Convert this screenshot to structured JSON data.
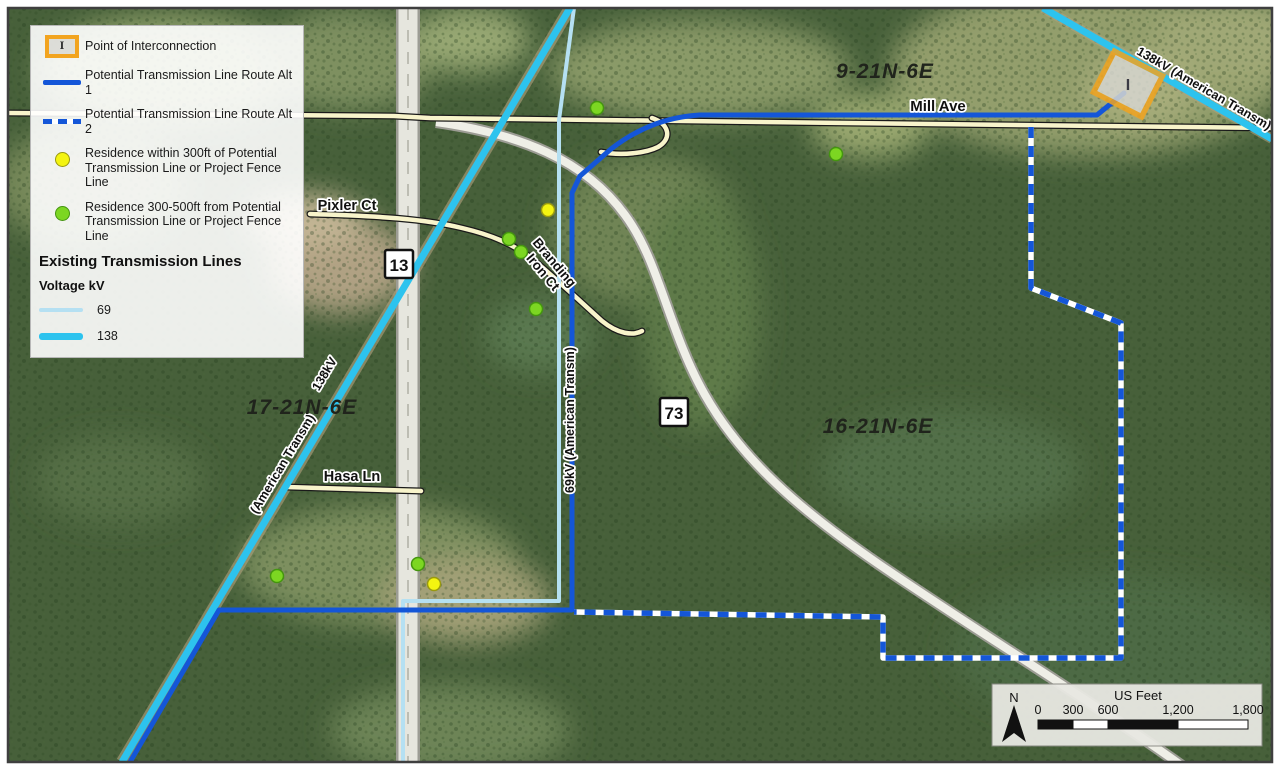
{
  "legend": {
    "poi_label": "Point of Interconnection",
    "alt1_label": "Potential Transmission Line Route Alt 1",
    "alt2_label": "Potential Transmission Line Route Alt 2",
    "res300_line1": "Residence within 300ft of Potential",
    "res300_line2": "Transmission Line or Project Fence Line",
    "res500_line1": "Residence 300-500ft from Potential",
    "res500_line2": "Transmission Line or Project Fence Line",
    "existing_heading": "Existing Transmission Lines",
    "voltage_label": "Voltage  kV",
    "kv69_label": "69",
    "kv138_label": "138"
  },
  "map_labels": {
    "mill_ave": "Mill Ave",
    "pixler_ct": "Pixler Ct",
    "branding_line1": "Branding",
    "branding_line2": "Iron Ct",
    "hasa_ln": "Hasa Ln",
    "hwy13_shield": "13",
    "hwy73_shield": "73",
    "township_9": "9-21N-6E",
    "township_17": "17-21N-6E",
    "township_16": "16-21N-6E",
    "kv138_left_text": "138kV",
    "kv138_left_owner": "(American Transm)",
    "kv138_right_text": "138kV   (American Transm)",
    "kv69_text": "69kV   (American Transm)",
    "poi_marker_letter": "I"
  },
  "scale_bar": {
    "north_label": "N",
    "units": "US Feet",
    "ticks": [
      "0",
      "300",
      "600",
      "1,200",
      "1,800"
    ]
  },
  "colors": {
    "route_blue": "#1456d8",
    "kv138_cyan": "#2dc3ee",
    "kv69_lightblue": "#b5e0f2",
    "residence_300_fill": "#f4f411",
    "residence_300_stroke": "#99990f",
    "residence_500_fill": "#7cd622",
    "residence_500_stroke": "#44950f",
    "poi_orange": "#f2a41f",
    "road_yellow": "#f8f4cb",
    "label_halo": "#ffffff"
  }
}
